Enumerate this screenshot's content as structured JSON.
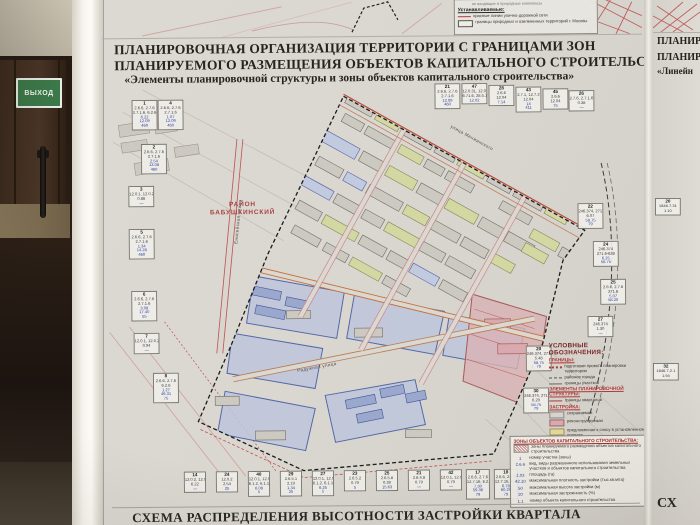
{
  "scene": {
    "exit_sign": "ВЫХОД"
  },
  "colors": {
    "accent_red": "#b03a3a",
    "orange": "#c4703c",
    "blue": "#5468a8",
    "paper": "#d8d5ce",
    "sign_green": "#3c7a4a"
  },
  "poster": {
    "title_line1": "ПЛАНИРОВОЧНАЯ ОРГАНИЗАЦИЯ ТЕРРИТОРИИ С ГРАНИЦАМИ ЗОН",
    "title_line2": "ПЛАНИРУЕМОГО РАЗМЕЩЕНИЯ ОБЪЕКТОВ КАПИТАЛЬНОГО СТРОИТЕЛЬСТВА",
    "title_line3": "«Элементы планировочной структуры и зоны объектов капитального строительства»",
    "bottom_title": "СХЕМА РАСПРЕДЕЛЕНИЯ ВЫСОТНОСТИ ЗАСТРОЙКИ КВАРТАЛА"
  },
  "map": {
    "district_label_line1": "РАЙОН",
    "district_label_line2": "БАБУШКИНСКИЙ",
    "street_labels": [
      {
        "text": "Енисейская улица",
        "x": 112,
        "y": 218,
        "rot": -84
      },
      {
        "text": "улица Менжинского",
        "x": 345,
        "y": 136,
        "rot": 29.5
      },
      {
        "text": "Радужная улица",
        "x": 192,
        "y": 364,
        "rot": -10
      }
    ]
  },
  "legend_top": {
    "partial_top": "не входящие в природные комплексы",
    "heading": "Устанавливаемые:",
    "items": [
      {
        "sym": "red-line",
        "label": "красные линии улично-дорожной сети"
      },
      {
        "sym": "bbox",
        "label": "границы природных и озелененных территорий г. Москвы"
      }
    ]
  },
  "legend_main": {
    "heading": "УСЛОВНЫЕ ОБОЗНАЧЕНИЯ:",
    "sections": [
      {
        "title": "ГРАНИЦЫ:",
        "items": [
          {
            "sym": "red-dotted",
            "label": "подготовки проекта планировки территории"
          },
          {
            "sym": "dash-dot",
            "label": "районов города"
          },
          {
            "sym": "thin-line",
            "label": "границы участков"
          }
        ]
      },
      {
        "title": "ЭЛЕМЕНТЫ ПЛАНИРОВОЧНОЙ СТРУКТУРЫ:",
        "items": [
          {
            "sym": "red-line",
            "label": "границы кварталов"
          }
        ]
      },
      {
        "title": "ЗАСТРОЙКА:",
        "items": [
          {
            "sym": "chip-gray",
            "label": "сохраняемая"
          },
          {
            "sym": "chip-pink",
            "label": "реконструируемая"
          },
          {
            "sym": "chip-yellow",
            "label": "предложенная к сносу в установленном порядке"
          }
        ]
      }
    ]
  },
  "legend_zones": {
    "heading": "ЗОНЫ ОБЪЕКТОВ КАПИТАЛЬНОГО СТРОИТЕЛЬСТВА:",
    "items": [
      {
        "sym": "hatch",
        "label": "зоны планируемого размещения объектов капитального строительства"
      },
      {
        "sym": "txt",
        "symtext": "1",
        "label": "номер участка (зоны)"
      },
      {
        "sym": "txt",
        "symtext": "2.6.6",
        "label": "вид, виды разрешенного использования земельных участков и объектов капитального строительства"
      },
      {
        "sym": "txt",
        "symtext": "1.03",
        "label": "площадь (га)"
      },
      {
        "sym": "txt",
        "symtext": "42.10",
        "label": "максимальная плотность застройки (тыс.кв.м/га)"
      },
      {
        "sym": "txt",
        "symtext": "50",
        "label": "максимальная высота застройки (м)"
      },
      {
        "sym": "txt",
        "symtext": "20",
        "label": "максимальная застроенность (%)"
      },
      {
        "sym": "txt",
        "symtext": "1.1",
        "label": "номер объекта капитального строительства"
      }
    ]
  },
  "right_poster": {
    "title_line1": "ПЛАНИР",
    "title_line2": "ПЛАНИР",
    "title_line3": "«Линейн",
    "bottom_fragment": "СХ"
  },
  "cells": [
    {
      "g": "main",
      "x": 29,
      "y": 98,
      "id": "1",
      "rows": [
        "2.6.6, 2.7.6",
        "2.7.1.6, 6.2.6",
        "6.22",
        "12.09",
        "460"
      ]
    },
    {
      "g": "main",
      "x": 55,
      "y": 98,
      "id": "4",
      "rows": [
        "2.6.6, 2.7.6",
        "2.7.1.6",
        "1.07",
        "12.09",
        "460"
      ]
    },
    {
      "g": "main",
      "x": 38,
      "y": 142,
      "id": "2",
      "rows": [
        "2.6.6, 2.7.6",
        "2.7.1.6",
        "2.54",
        "13.08",
        "460"
      ]
    },
    {
      "g": "main",
      "x": 25,
      "y": 184,
      "id": "3",
      "rows": [
        "12.0.1, 12.0.2",
        "0.86",
        "—"
      ]
    },
    {
      "g": "main",
      "x": 25,
      "y": 227,
      "id": "5",
      "rows": [
        "2.6.6, 2.7.6",
        "2.7.1.6",
        "1.34",
        "14.28",
        "460"
      ]
    },
    {
      "g": "main",
      "x": 27,
      "y": 289,
      "id": "6",
      "rows": [
        "2.6.6, 2.7.6",
        "2.7.1.6",
        "3.08",
        "17.40",
        "55"
      ]
    },
    {
      "g": "main",
      "x": 29,
      "y": 331,
      "id": "7",
      "rows": [
        "12.0.1, 12.0.2",
        "0.94",
        "—"
      ]
    },
    {
      "g": "main",
      "x": 48,
      "y": 371,
      "id": "8",
      "rows": [
        "2.6.6, 2.7.6",
        "6.2.6",
        "1.27",
        "46.31",
        "75"
      ]
    },
    {
      "g": "main",
      "x": 332,
      "y": 84,
      "id": "21",
      "rows": [
        "2.6.6, 2.7.6",
        "2.7.1.6",
        "12.09",
        "460"
      ]
    },
    {
      "g": "main",
      "x": 359,
      "y": 84,
      "id": "47",
      "rows": [
        "12.0.31, 12.0.2",
        "6.71.6, 28.5.1",
        "12.02"
      ]
    },
    {
      "g": "main",
      "x": 386,
      "y": 86,
      "id": "28",
      "rows": [
        "2.6.6",
        "12.04",
        "7.14"
      ]
    },
    {
      "g": "main",
      "x": 413,
      "y": 88,
      "id": "43",
      "rows": [
        "2.7.1, 12.7.2",
        "12.04",
        "14",
        "411"
      ]
    },
    {
      "g": "main",
      "x": 440,
      "y": 90,
      "id": "45",
      "rows": [
        "2.6.6",
        "12.04",
        "75"
      ]
    },
    {
      "g": "main",
      "x": 466,
      "y": 92,
      "id": "26",
      "rows": [
        "2.7.6, 2.7.1.6",
        "0.38",
        "—"
      ]
    },
    {
      "g": "main",
      "x": 474,
      "y": 205,
      "id": "22",
      "rows": [
        "246.374, 271.6",
        "6.07",
        "58.75",
        "79"
      ]
    },
    {
      "g": "main",
      "x": 489,
      "y": 243,
      "id": "24",
      "rows": [
        "246.374",
        "271.6-638",
        "6.25",
        "56.75"
      ]
    },
    {
      "g": "main",
      "x": 496,
      "y": 281,
      "id": "25",
      "rows": [
        "2.6.6, 2.7.6",
        "271.6",
        "5.07",
        "58.20"
      ]
    },
    {
      "g": "main",
      "x": 483,
      "y": 318,
      "id": "27",
      "rows": [
        "246.374",
        "1.30",
        "—"
      ]
    },
    {
      "g": "main",
      "x": 421,
      "y": 347,
      "id": "20",
      "rows": [
        "246.374, 271.6",
        "5.48",
        "58.75",
        "79"
      ]
    },
    {
      "g": "main",
      "x": 418,
      "y": 389,
      "id": "30",
      "rows": [
        "246.374, 271.6",
        "6.20",
        "58.75",
        "79"
      ]
    },
    {
      "g": "main",
      "x": 78,
      "y": 470,
      "w": 22,
      "id": "14",
      "rows": [
        "12.0.2, 12.0.4",
        "6.22",
        "—"
      ]
    },
    {
      "g": "main",
      "x": 110,
      "y": 470,
      "w": 22,
      "id": "24",
      "rows": [
        "12.0.2",
        "2.54",
        "25"
      ]
    },
    {
      "g": "main",
      "x": 142,
      "y": 470,
      "w": 22,
      "id": "40",
      "rows": [
        "12.0.1, 12.0.2",
        "6.1.2, 6.1.1",
        "6.08",
        "5"
      ]
    },
    {
      "g": "main",
      "x": 174,
      "y": 470,
      "w": 22,
      "id": "29",
      "rows": [
        "2.6.5.1",
        "2.19",
        "1.34",
        "25"
      ]
    },
    {
      "g": "main",
      "x": 206,
      "y": 470,
      "w": 22,
      "id": "27",
      "rows": [
        "12.0.1, 12.0.2",
        "6.1.2, 6.1.1",
        "6.25",
        "5"
      ]
    },
    {
      "g": "main",
      "x": 238,
      "y": 470,
      "w": 22,
      "id": "23",
      "rows": [
        "2.6.5.2",
        "0.79",
        "5"
      ]
    },
    {
      "g": "main",
      "x": 270,
      "y": 470,
      "w": 22,
      "id": "25",
      "rows": [
        "2.6.5.8",
        "0.39",
        "15.63"
      ]
    },
    {
      "g": "main",
      "x": 302,
      "y": 470,
      "w": 22,
      "id": "21",
      "rows": [
        "2.6.4.8",
        "0.79",
        "—"
      ]
    },
    {
      "g": "main",
      "x": 334,
      "y": 470,
      "w": 22,
      "id": "42",
      "rows": [
        "12.0.1, 12.0.2",
        "0.79",
        "—"
      ]
    },
    {
      "g": "main",
      "x": 360,
      "y": 470,
      "w": 24,
      "id": "17",
      "rows": [
        "2.6.6, 2.7.6",
        "12.7.16, 6.2.6",
        "7.30",
        "59.36",
        "79"
      ]
    },
    {
      "g": "main",
      "x": 388,
      "y": 470,
      "w": 24,
      "id": "18",
      "rows": [
        "2.6.6, 2.7.6",
        "12.7.16, 6.2.6",
        "6.78",
        "60.29",
        "79"
      ]
    },
    {
      "g": "right",
      "x": 2,
      "y": 198,
      "w": 26,
      "id": "20",
      "rows": [
        "1846.7.31",
        "1.10"
      ]
    },
    {
      "g": "right",
      "x": 0,
      "y": 363,
      "w": 26,
      "id": "32",
      "rows": [
        "1846.7.2.1",
        "1.94"
      ]
    }
  ]
}
